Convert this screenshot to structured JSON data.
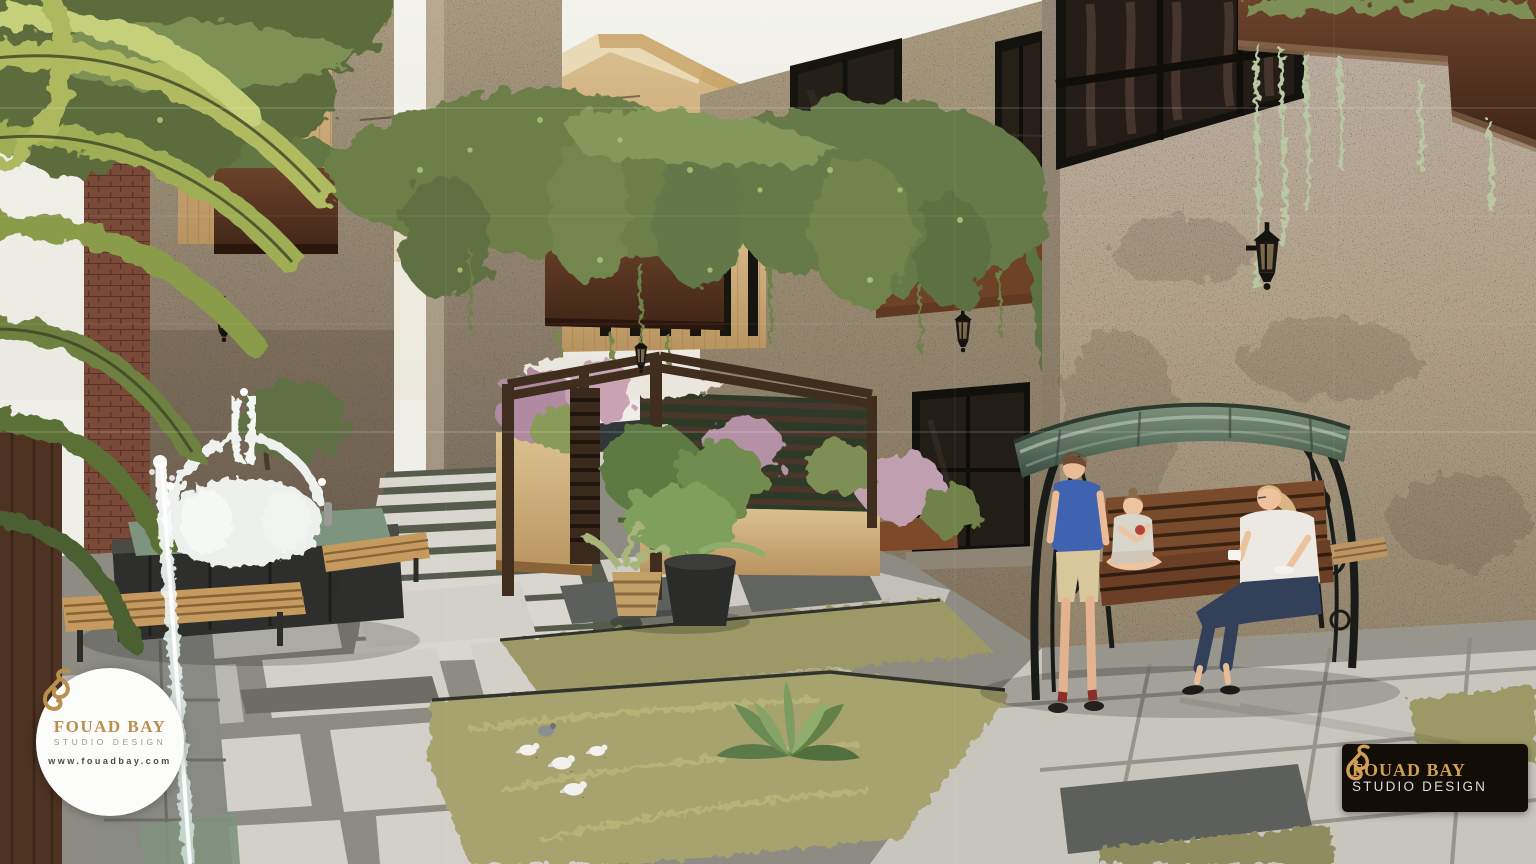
{
  "watermarks": {
    "badge": {
      "brand": "FOUAD BAY",
      "tagline": "STUDIO DESIGN",
      "website": "www.fouadbay.com"
    },
    "plate": {
      "brand": "FOUAD BAY",
      "tagline": "STUDIO DESIGN"
    }
  },
  "palette": {
    "sky": "#f1f0ea",
    "stone_sun": "#b3a58b",
    "stone_shade": "#9c8d74",
    "wood_light": "#cfae74",
    "walnut": "#5b3a26",
    "vine": "#6c7f4a",
    "palm": "#b0ba60",
    "grass": "#a6a36e",
    "paver_light": "#d2d0c8",
    "paver_dark": "#5d5f5d",
    "pool": "#7d947e",
    "canopy": "#5b6f5e",
    "iron": "#181b18",
    "boy_shirt": "#3f63b0",
    "jeans": "#33405a",
    "gold": "#b98f4f"
  },
  "scene": {
    "elements": [
      "travertine courtyard buildings",
      "hanging vine canopy on wires",
      "wall planter boxes with trailing plants",
      "stone fountain with splashing water",
      "falling water jet",
      "pergola seating nook with flowering planters",
      "canopy swing bench with woman and two children",
      "paver paths with grass joints",
      "agave, potted plants and doves",
      "wall lanterns"
    ]
  }
}
